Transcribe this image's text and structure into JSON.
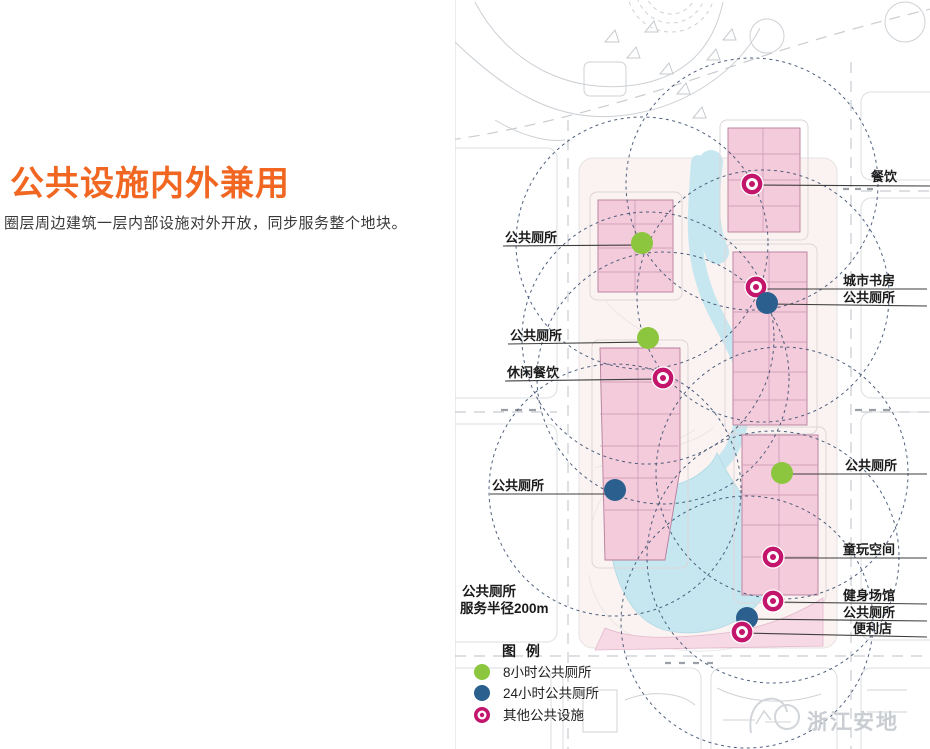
{
  "left_panel": {
    "title": "公共设施内外兼用",
    "subtitle": "圈层周边建筑一层内部设施对外开放，同步服务整个地块。"
  },
  "map": {
    "annotations": [
      {
        "label": "餐饮",
        "type": "other_facility"
      },
      {
        "label": "公共厕所",
        "type": "toilet_8h"
      },
      {
        "label": "城市书房",
        "type": "other_facility"
      },
      {
        "label": "公共厕所",
        "type": "toilet_24h"
      },
      {
        "label": "公共厕所",
        "type": "toilet_8h"
      },
      {
        "label": "休闲餐饮",
        "type": "other_facility"
      },
      {
        "label": "公共厕所",
        "type": "toilet_24h"
      },
      {
        "label": "公共厕所",
        "type": "toilet_8h"
      },
      {
        "label": "童玩空间",
        "type": "other_facility"
      },
      {
        "label": "健身场馆",
        "type": "other_facility"
      },
      {
        "label": "公共厕所",
        "type": "toilet_24h"
      },
      {
        "label": "便利店",
        "type": "other_facility"
      }
    ],
    "note_line1": "公共厕所",
    "note_line2": "服务半径200m",
    "legend": {
      "title": "图 例",
      "items": [
        {
          "label": "8小时公共厕所"
        },
        {
          "label": "24小时公共厕所"
        },
        {
          "label": "其他公共设施"
        }
      ]
    },
    "watermark": "浙江安地",
    "colors": {
      "accent_orange": "#F16722",
      "toilet_8h": "#8CC63E",
      "toilet_24h": "#2B5F8E",
      "other_facility": "#C2156B",
      "radius_circle": "#3D4F70",
      "water": "#C6E7F0",
      "building": "#F3CBDA"
    }
  }
}
